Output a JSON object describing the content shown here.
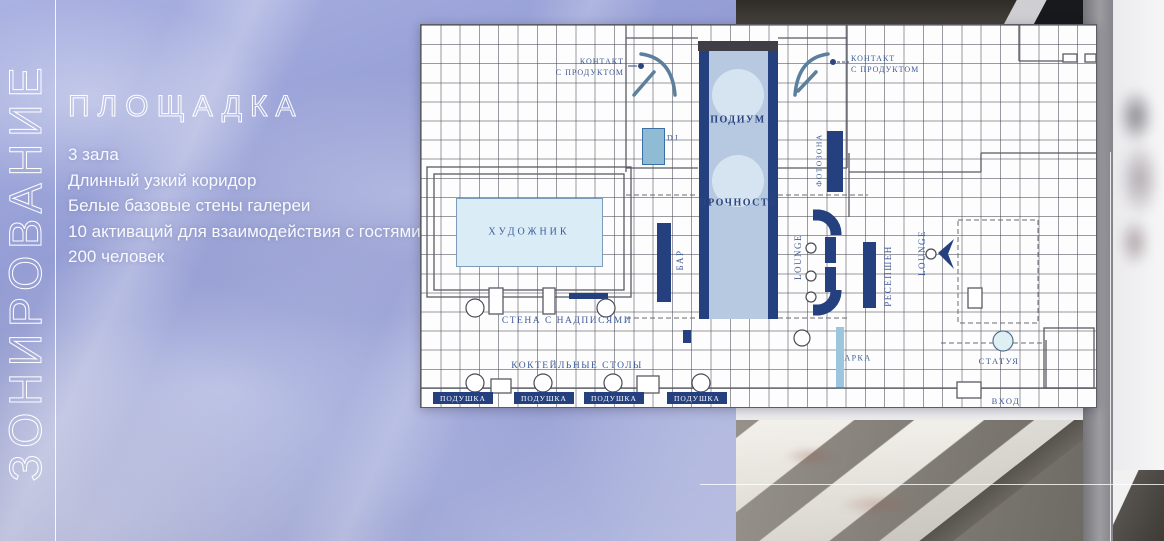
{
  "slide": {
    "vertical_title": "ЗОНИРОВАНИЕ",
    "title": "ПЛОЩАДКА",
    "bullets": [
      "3 зала",
      "Длинный узкий коридор",
      "Белые базовые стены галереи",
      "10 активаций для взаимодействия с гостями",
      "200 человек"
    ]
  },
  "plan": {
    "labels": {
      "contact_line1": "КОНТАКТ",
      "contact_line2": "С ПРОДУКТОМ",
      "podium": "ПОДИУМ",
      "strength": "ПРОЧНОСТЬ",
      "dj": "DJ",
      "bar": "БАР",
      "photo_zone": "ФОТОЗОНА",
      "lounge": "LOUNGE",
      "reception": "РЕСЕПШЕН",
      "artist": "ХУДОЖНИК",
      "inscription_wall": "СТЕНА С НАДПИСЯМИ",
      "cocktail_tables": "КОКТЕЙЛЬНЫЕ СТОЛЫ",
      "arch": "АРКА",
      "statue": "СТАТУЯ",
      "entrance": "ВХОД",
      "pillow": "ПОДУШКА"
    }
  },
  "colors": {
    "background_lavender": "#99a2d8",
    "plan_navy": "#24407e",
    "plan_label_blue": "#3d5a98",
    "podium_fill": "#b6c9e0",
    "podium_circle": "#d6e4f2",
    "dj_fill": "#8fbcd4",
    "arch_fill": "#9cc6de",
    "text_white": "#ffffff"
  }
}
